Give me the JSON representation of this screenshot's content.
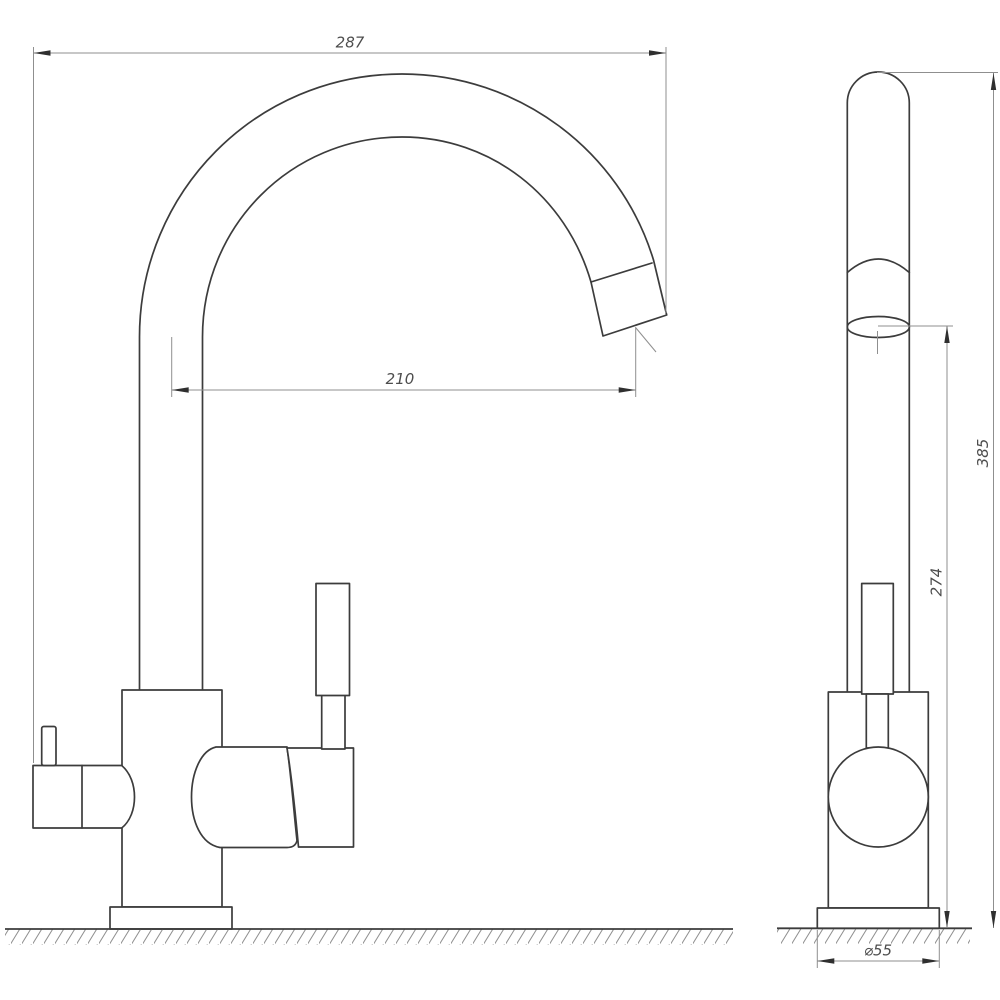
{
  "drawing": {
    "kind": "faucet-technical-drawing",
    "views": [
      "front",
      "side"
    ]
  },
  "colors": {
    "outline": "#3c3c3c",
    "dim": "#8f8f8f",
    "arrow": "#2f2f2f",
    "text": "#4d4d4d",
    "bg": "#ffffff"
  },
  "dimensions": {
    "spout_width": {
      "value": "287"
    },
    "spout_reach": {
      "value": "210"
    },
    "total_height": {
      "value": "385"
    },
    "outlet_height": {
      "value": "274"
    },
    "base_diameter": {
      "value": "⌀55"
    }
  }
}
